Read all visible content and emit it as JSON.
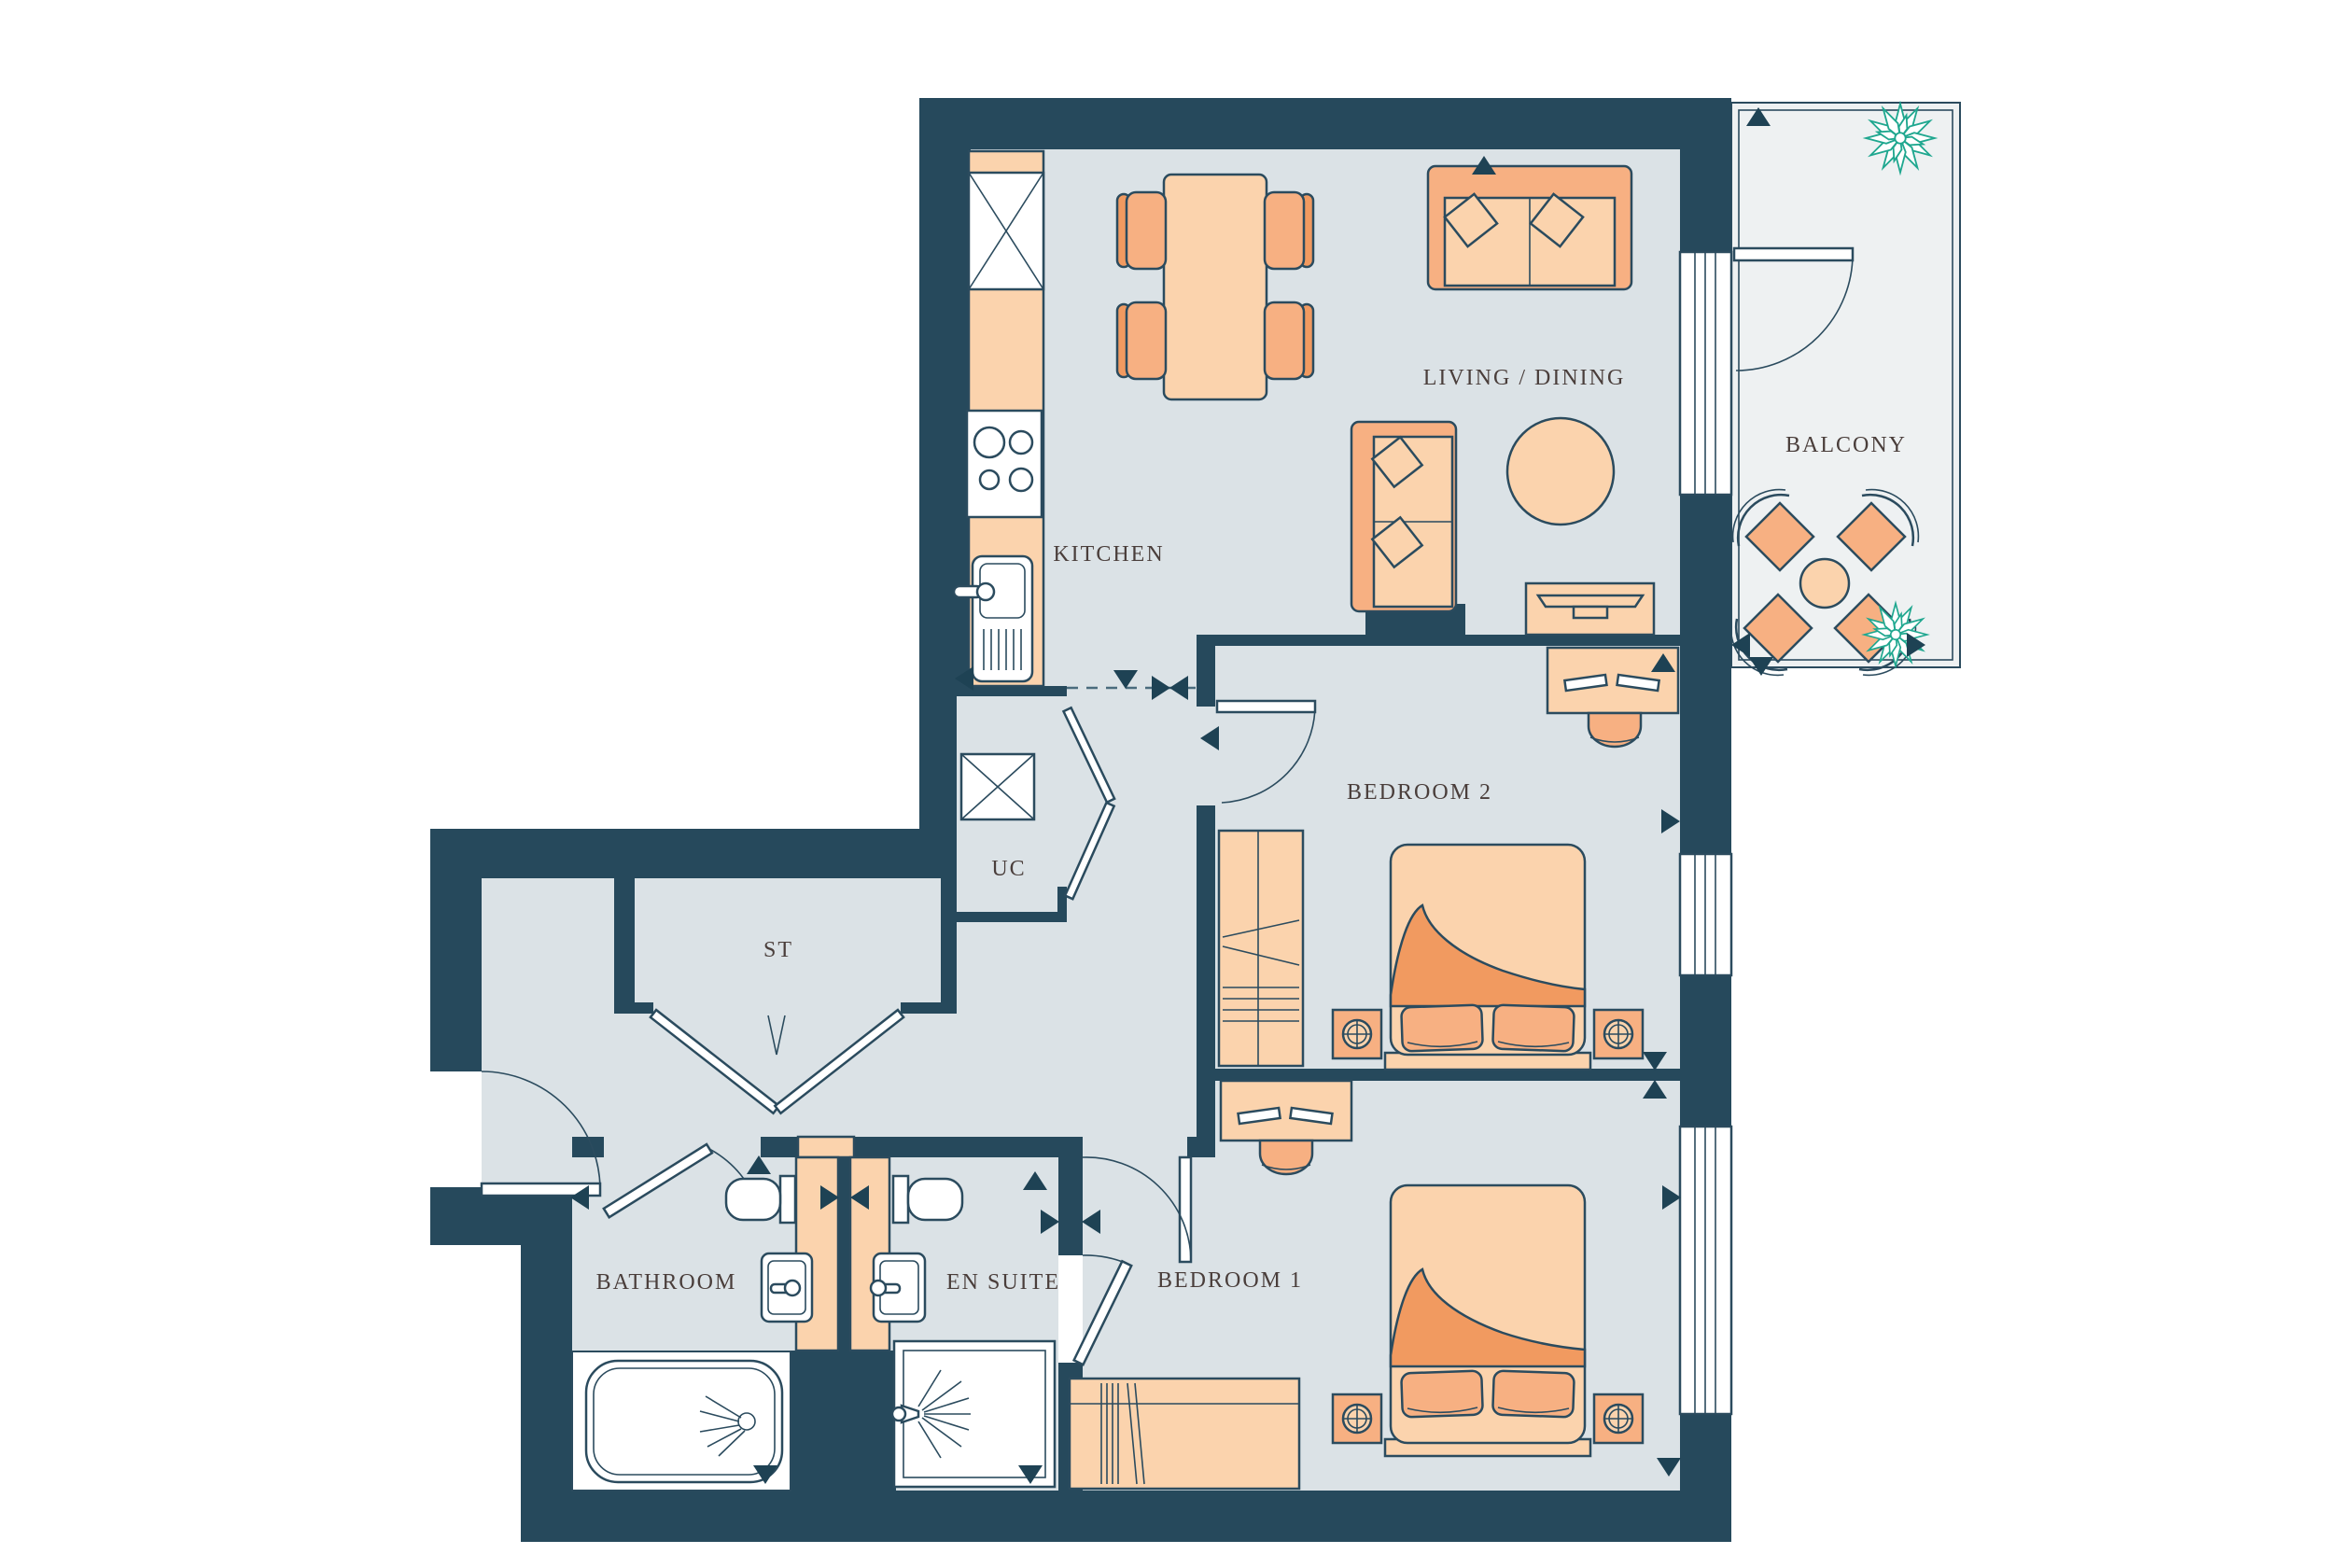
{
  "plan": {
    "type": "apartment-floor-plan",
    "rooms": [
      {
        "id": "living-dining",
        "label": "LIVING / DINING"
      },
      {
        "id": "kitchen",
        "label": "KITCHEN"
      },
      {
        "id": "balcony",
        "label": "BALCONY"
      },
      {
        "id": "bedroom-2",
        "label": "BEDROOM 2"
      },
      {
        "id": "bedroom-1",
        "label": "BEDROOM 1"
      },
      {
        "id": "bathroom",
        "label": "BATHROOM"
      },
      {
        "id": "en-suite",
        "label": "EN SUITE"
      },
      {
        "id": "storage",
        "label": "ST"
      },
      {
        "id": "utility-cupboard",
        "label": "UC"
      }
    ],
    "icons": {
      "plant": "starburst-plant-icon",
      "direction_marker": "triangle-marker-icon",
      "lamp": "circle-cross-lamp-icon"
    }
  },
  "colors": {
    "wall": "#26495C",
    "line": "#2B4B5E",
    "floor": "#DBE2E6",
    "floorOuter": "#EEF1F2",
    "peachLight": "#FBD3AD",
    "peachMid": "#F7B082",
    "peachDeep": "#F19A60",
    "plant": "#1FA78F",
    "marker": "#1E4254",
    "label": "#4A3E3B"
  }
}
